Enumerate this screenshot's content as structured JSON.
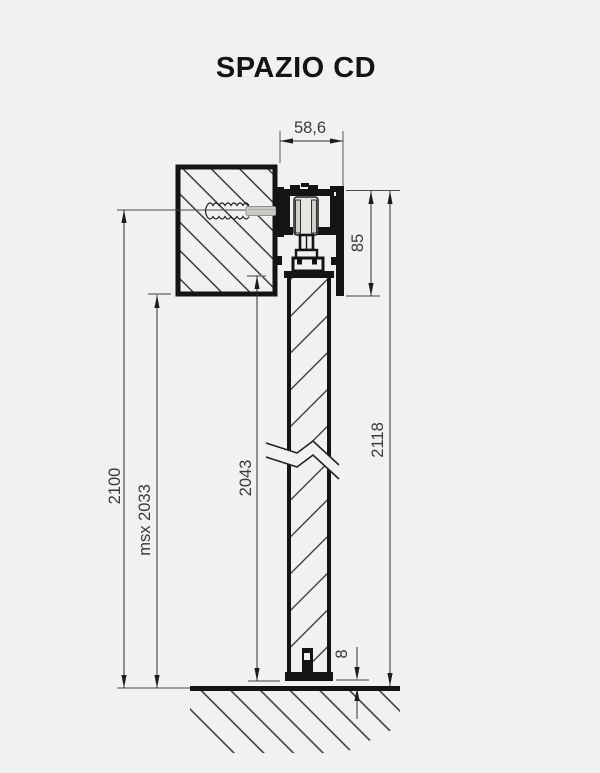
{
  "title": "SPAZIO CD",
  "dims": {
    "track_width": "58,6",
    "header_height": "85",
    "overall_height": "2118",
    "clear_height": "2100",
    "max_height": "msx 2033",
    "door_height": "2043",
    "floor_gap": "8"
  },
  "colors": {
    "background": "#f1f1ef",
    "line": "#141414",
    "dim_text": "#3a3a3a"
  }
}
